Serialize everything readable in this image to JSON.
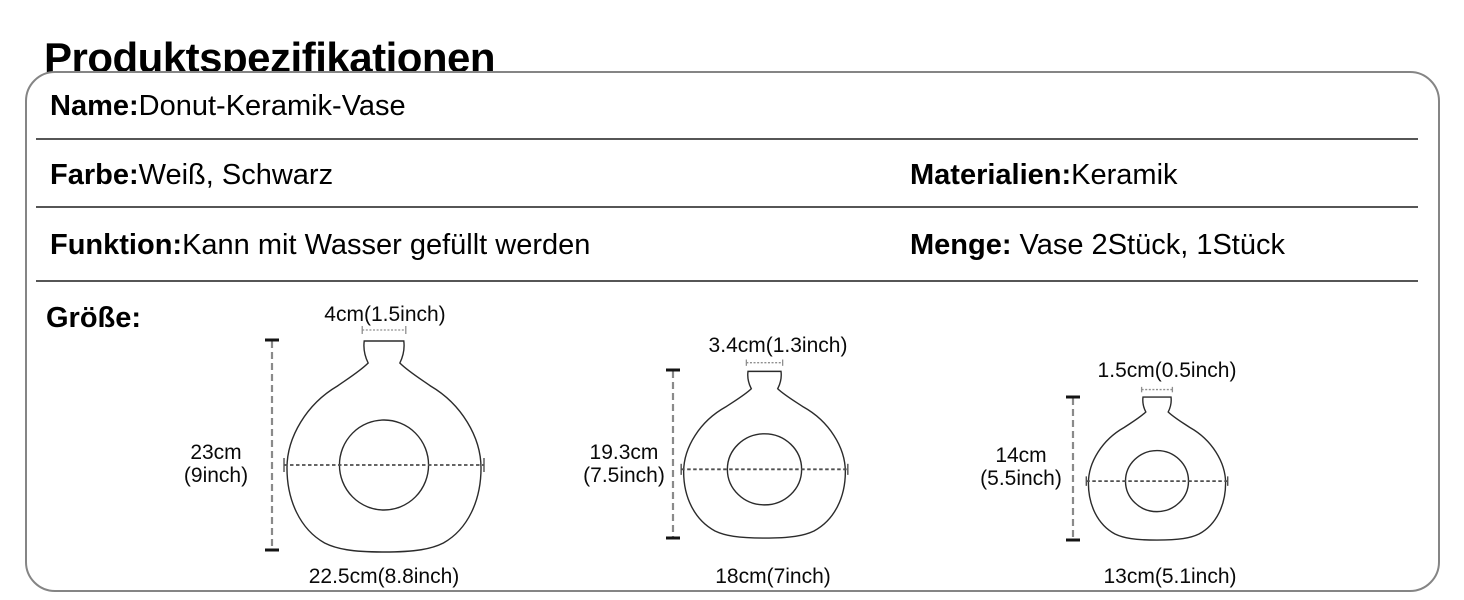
{
  "header": {
    "title": "Produktspezifikationen"
  },
  "specs": {
    "name": {
      "label": "Name:",
      "value": "Donut-Keramik-Vase"
    },
    "color": {
      "label": "Farbe:",
      "value": "Weiß, Schwarz"
    },
    "material": {
      "label": "Materialien:",
      "value": "Keramik"
    },
    "function": {
      "label": "Funktion:",
      "value": "Kann mit Wasser gefüllt werden"
    },
    "quantity": {
      "label": "Menge:",
      "value": " Vase 2Stück, 1Stück"
    },
    "size": {
      "label": "Größe:"
    }
  },
  "diagrams": [
    {
      "name": "large-vase",
      "top_width": "4cm(1.5inch)",
      "height_cm": "23cm",
      "height_inch": "(9inch)",
      "bottom_width": "22.5cm(8.8inch)"
    },
    {
      "name": "medium-vase",
      "top_width": "3.4cm(1.3inch)",
      "height_cm": "19.3cm",
      "height_inch": "(7.5inch)",
      "bottom_width": "18cm(7inch)"
    },
    {
      "name": "small-vase",
      "top_width": "1.5cm(0.5inch)",
      "height_cm": "14cm",
      "height_inch": "(5.5inch)",
      "bottom_width": "13cm(5.1inch)"
    }
  ],
  "colors": {
    "box_border": "#858585",
    "divider": "#565656",
    "vase_outline": "#2b2b2b",
    "measure_line": "#8a8a8a",
    "text": "#000000"
  }
}
